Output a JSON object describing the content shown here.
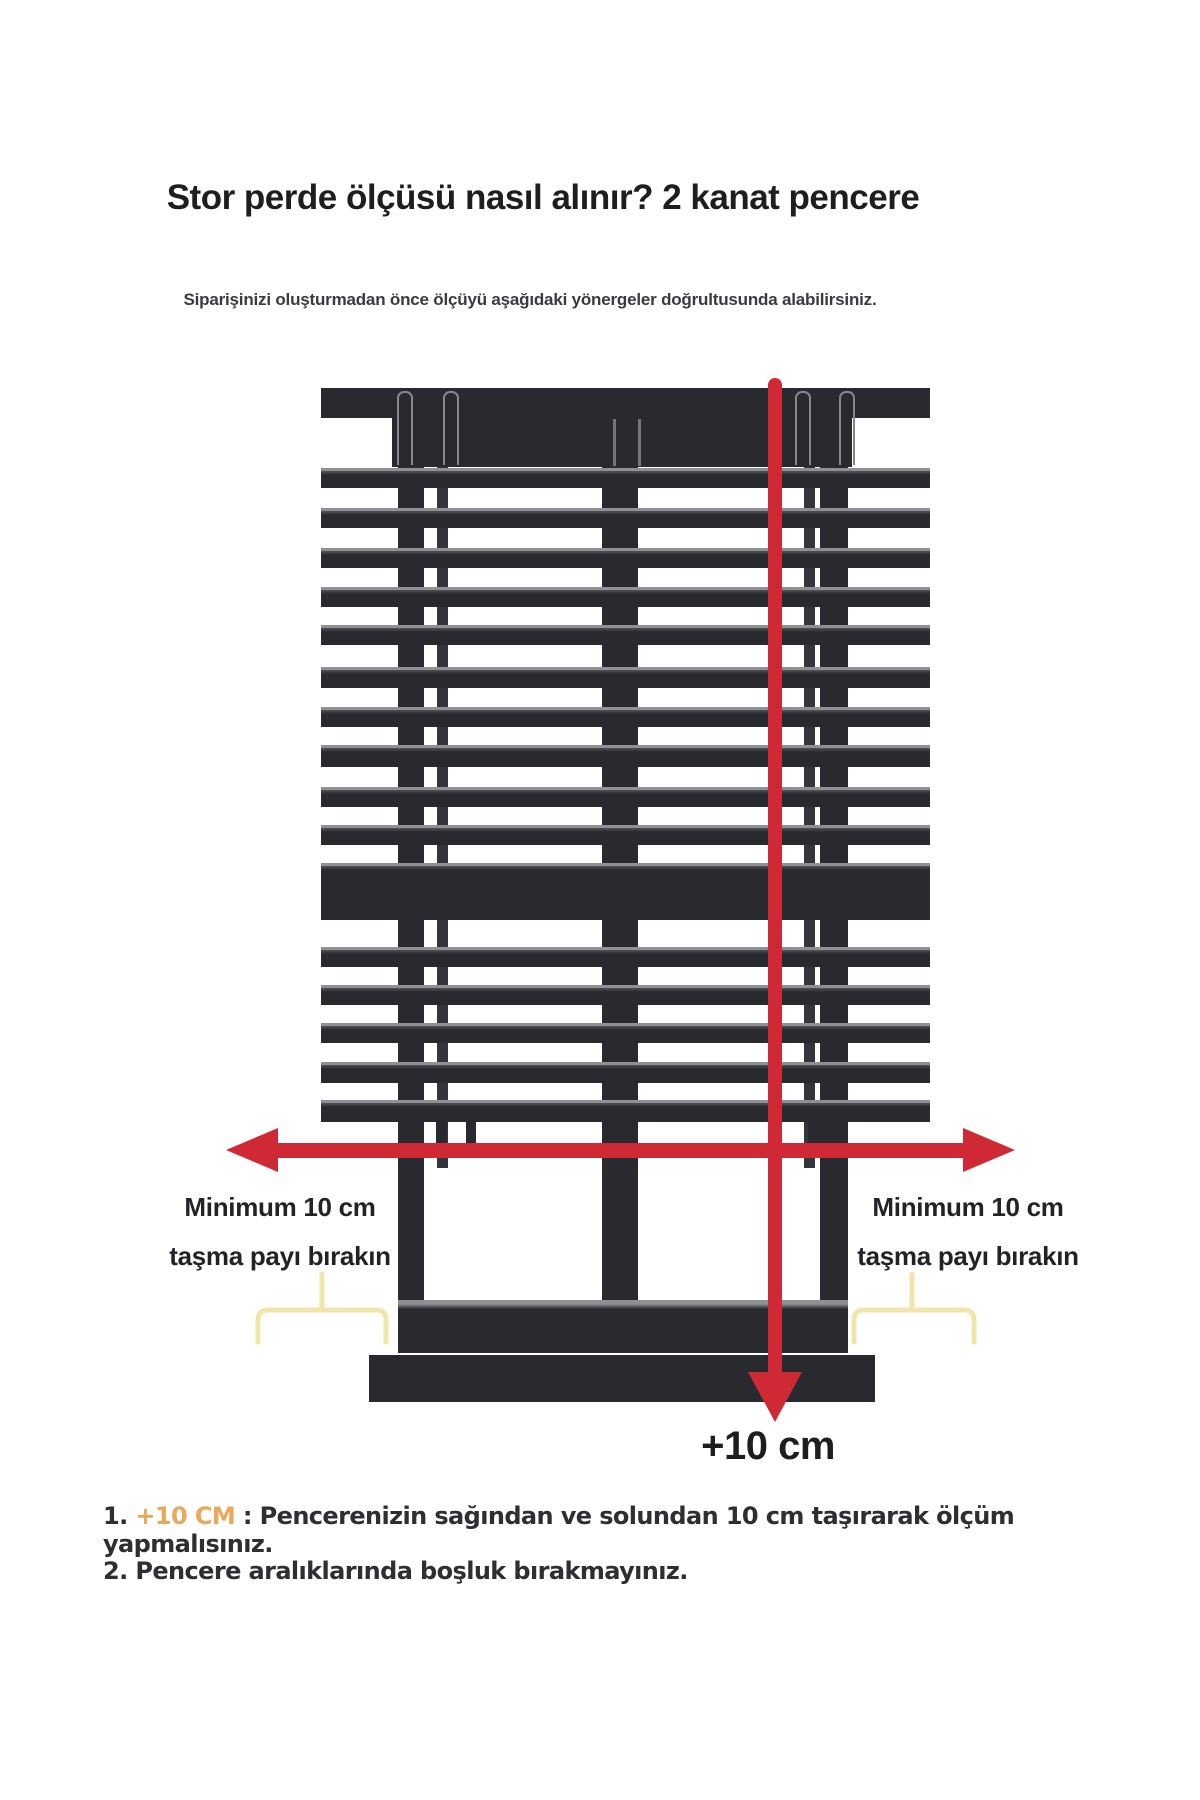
{
  "header": {
    "title": "Stor perde ölçüsü nasıl alınır? 2 kanat pencere",
    "subtitle": "Siparişinizi oluşturmadan önce ölçüyü aşağıdaki yönergeler doğrultusunda alabilirsiniz."
  },
  "diagram": {
    "left_overhang_label": {
      "line1": "Minimum 10 cm",
      "line2": "taşma payı bırakın"
    },
    "right_overhang_label": {
      "line1": "Minimum 10 cm",
      "line2": "taşma payı bırakın"
    },
    "bottom_extension_label": "+10 cm",
    "colors": {
      "frame": "#282a30",
      "arrow": "#cf2936",
      "bracket": "#f0e6aa"
    }
  },
  "notes": {
    "item1": {
      "number": "1. ",
      "highlight": "+10 CM",
      "text": " : Pencerenizin sağından ve solundan 10 cm taşırarak ölçüm yapmalısınız."
    },
    "item2": "2. Pencere aralıklarında boşluk bırakmayınız.",
    "highlight_color": "#e9a959"
  }
}
